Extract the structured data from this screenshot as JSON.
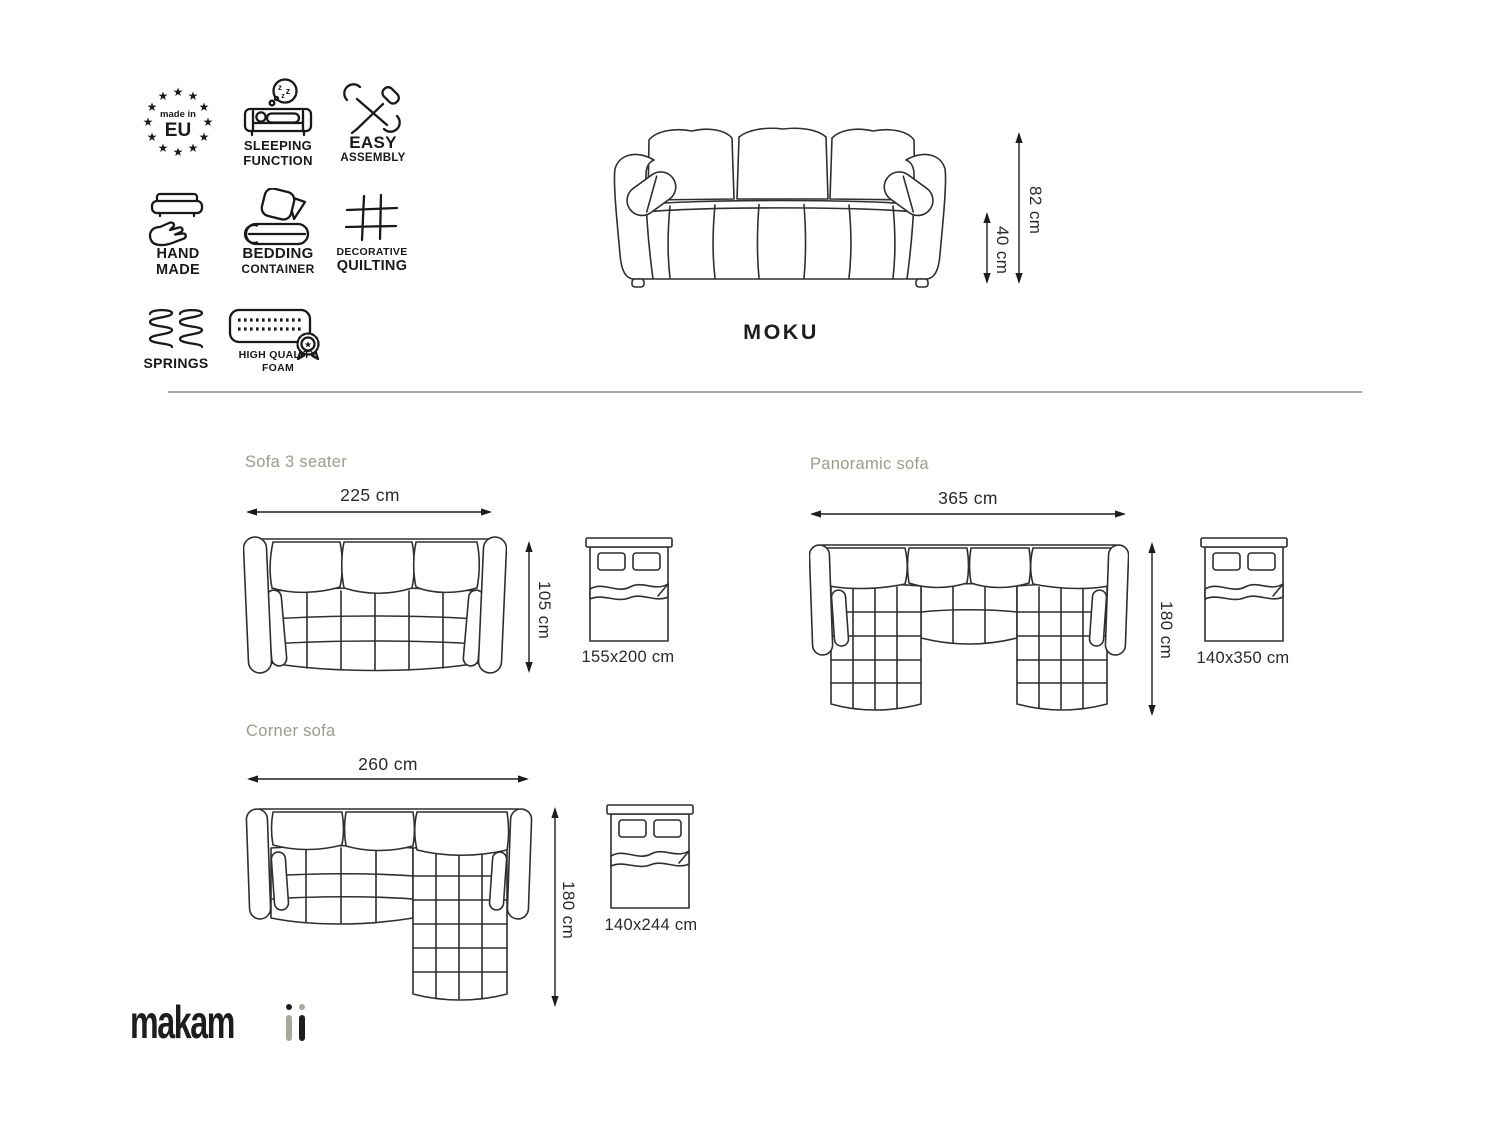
{
  "colors": {
    "line_art": "#2f2f2f",
    "icon_ink": "#191919",
    "text_ink": "#1d1d1b",
    "muted_label": "#9b9c8d",
    "divider": "#a9a9a9",
    "background": "#ffffff"
  },
  "features": {
    "made_in_eu": {
      "top": "made in",
      "main": "EU"
    },
    "sleeping": {
      "line1": "SLEEPING",
      "line2": "FUNCTION",
      "z": "z"
    },
    "assembly": {
      "line1": "EASY",
      "line2": "ASSEMBLY"
    },
    "handmade": {
      "line1": "HAND",
      "line2": "MADE"
    },
    "bedding": {
      "line1": "BEDDING",
      "line2": "CONTAINER"
    },
    "quilting": {
      "line1": "DECORATIVE",
      "line2": "QUILTING"
    },
    "springs": {
      "line1": "SPRINGS"
    },
    "foam": {
      "line1": "HIGH QUALITY",
      "line2": "FOAM"
    }
  },
  "front_view": {
    "model_name": "MOKU",
    "total_height": "82 cm",
    "seat_height": "40 cm"
  },
  "variants": {
    "three_seater": {
      "title": "Sofa 3 seater",
      "width": "225 cm",
      "depth": "105 cm",
      "bed_size": "155x200 cm"
    },
    "panoramic": {
      "title": "Panoramic sofa",
      "width": "365 cm",
      "depth": "180 cm",
      "bed_size": "140x350 cm"
    },
    "corner": {
      "title": "Corner sofa",
      "width": "260 cm",
      "depth": "180 cm",
      "bed_size": "140x244 cm"
    }
  },
  "brand": {
    "name": "makamii",
    "logo_text": "makam"
  }
}
